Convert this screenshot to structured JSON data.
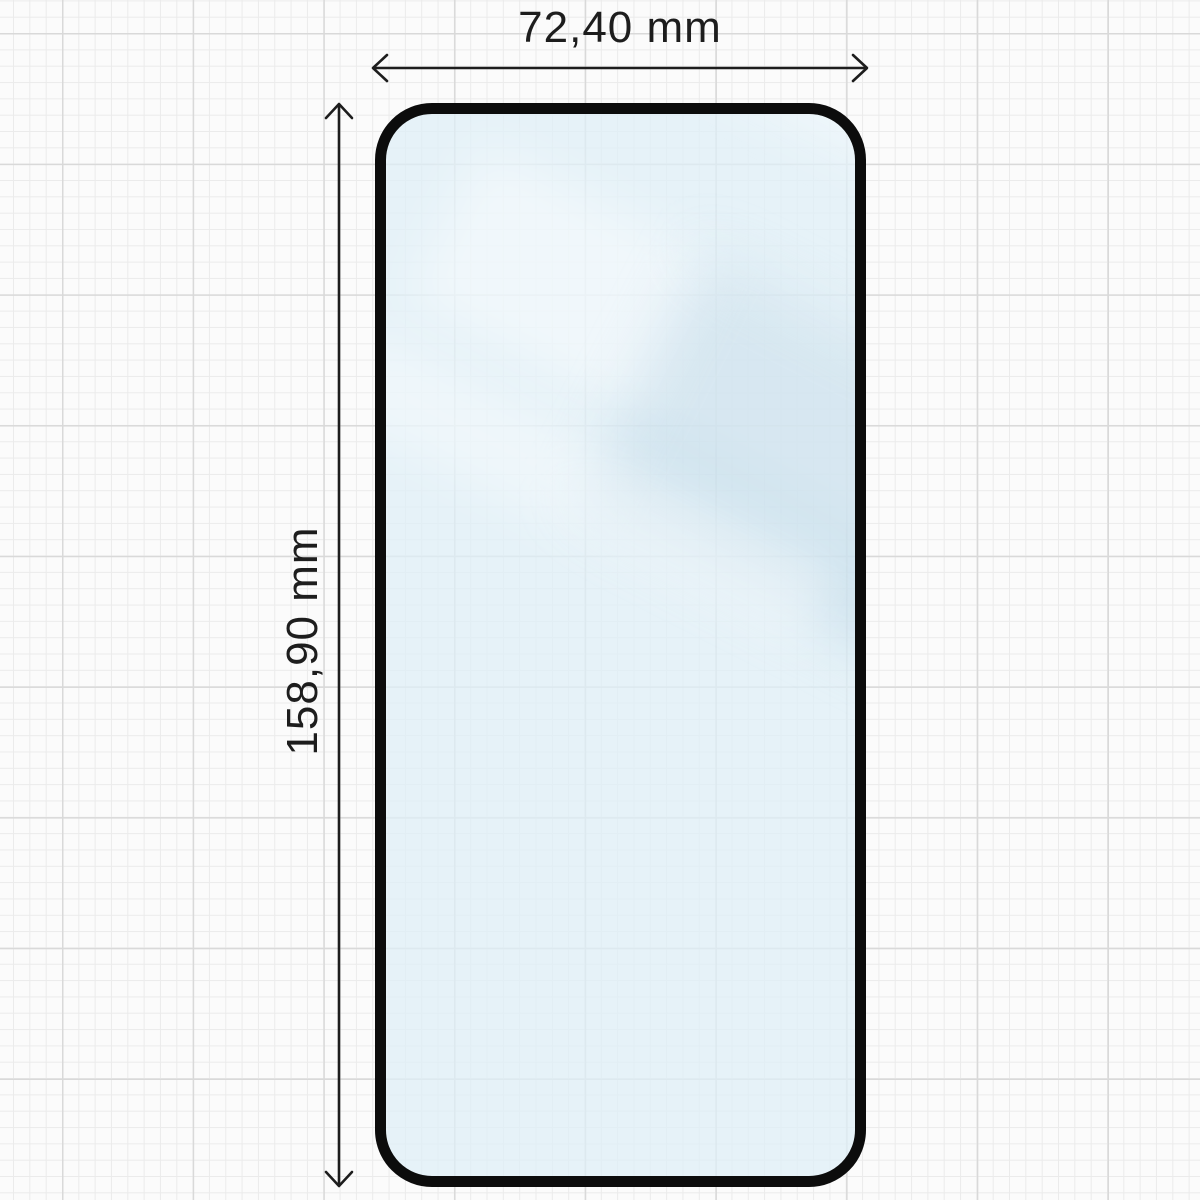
{
  "diagram": {
    "type": "screen-protector-dimension-diagram",
    "width_label": "72,40 mm",
    "height_label": "158,90 mm",
    "icons": {
      "width_arrow": "double-headed-horizontal-arrow",
      "height_arrow": "double-headed-vertical-arrow"
    },
    "colors": {
      "background": "#fbfbfb",
      "grid_minor": "#ebebeb",
      "grid_major": "#d9d9d9",
      "dimension": "#1d1d1d",
      "glass_border": "#0c0c0c",
      "glass_fill": "rgba(222,238,246,0.72)"
    }
  }
}
